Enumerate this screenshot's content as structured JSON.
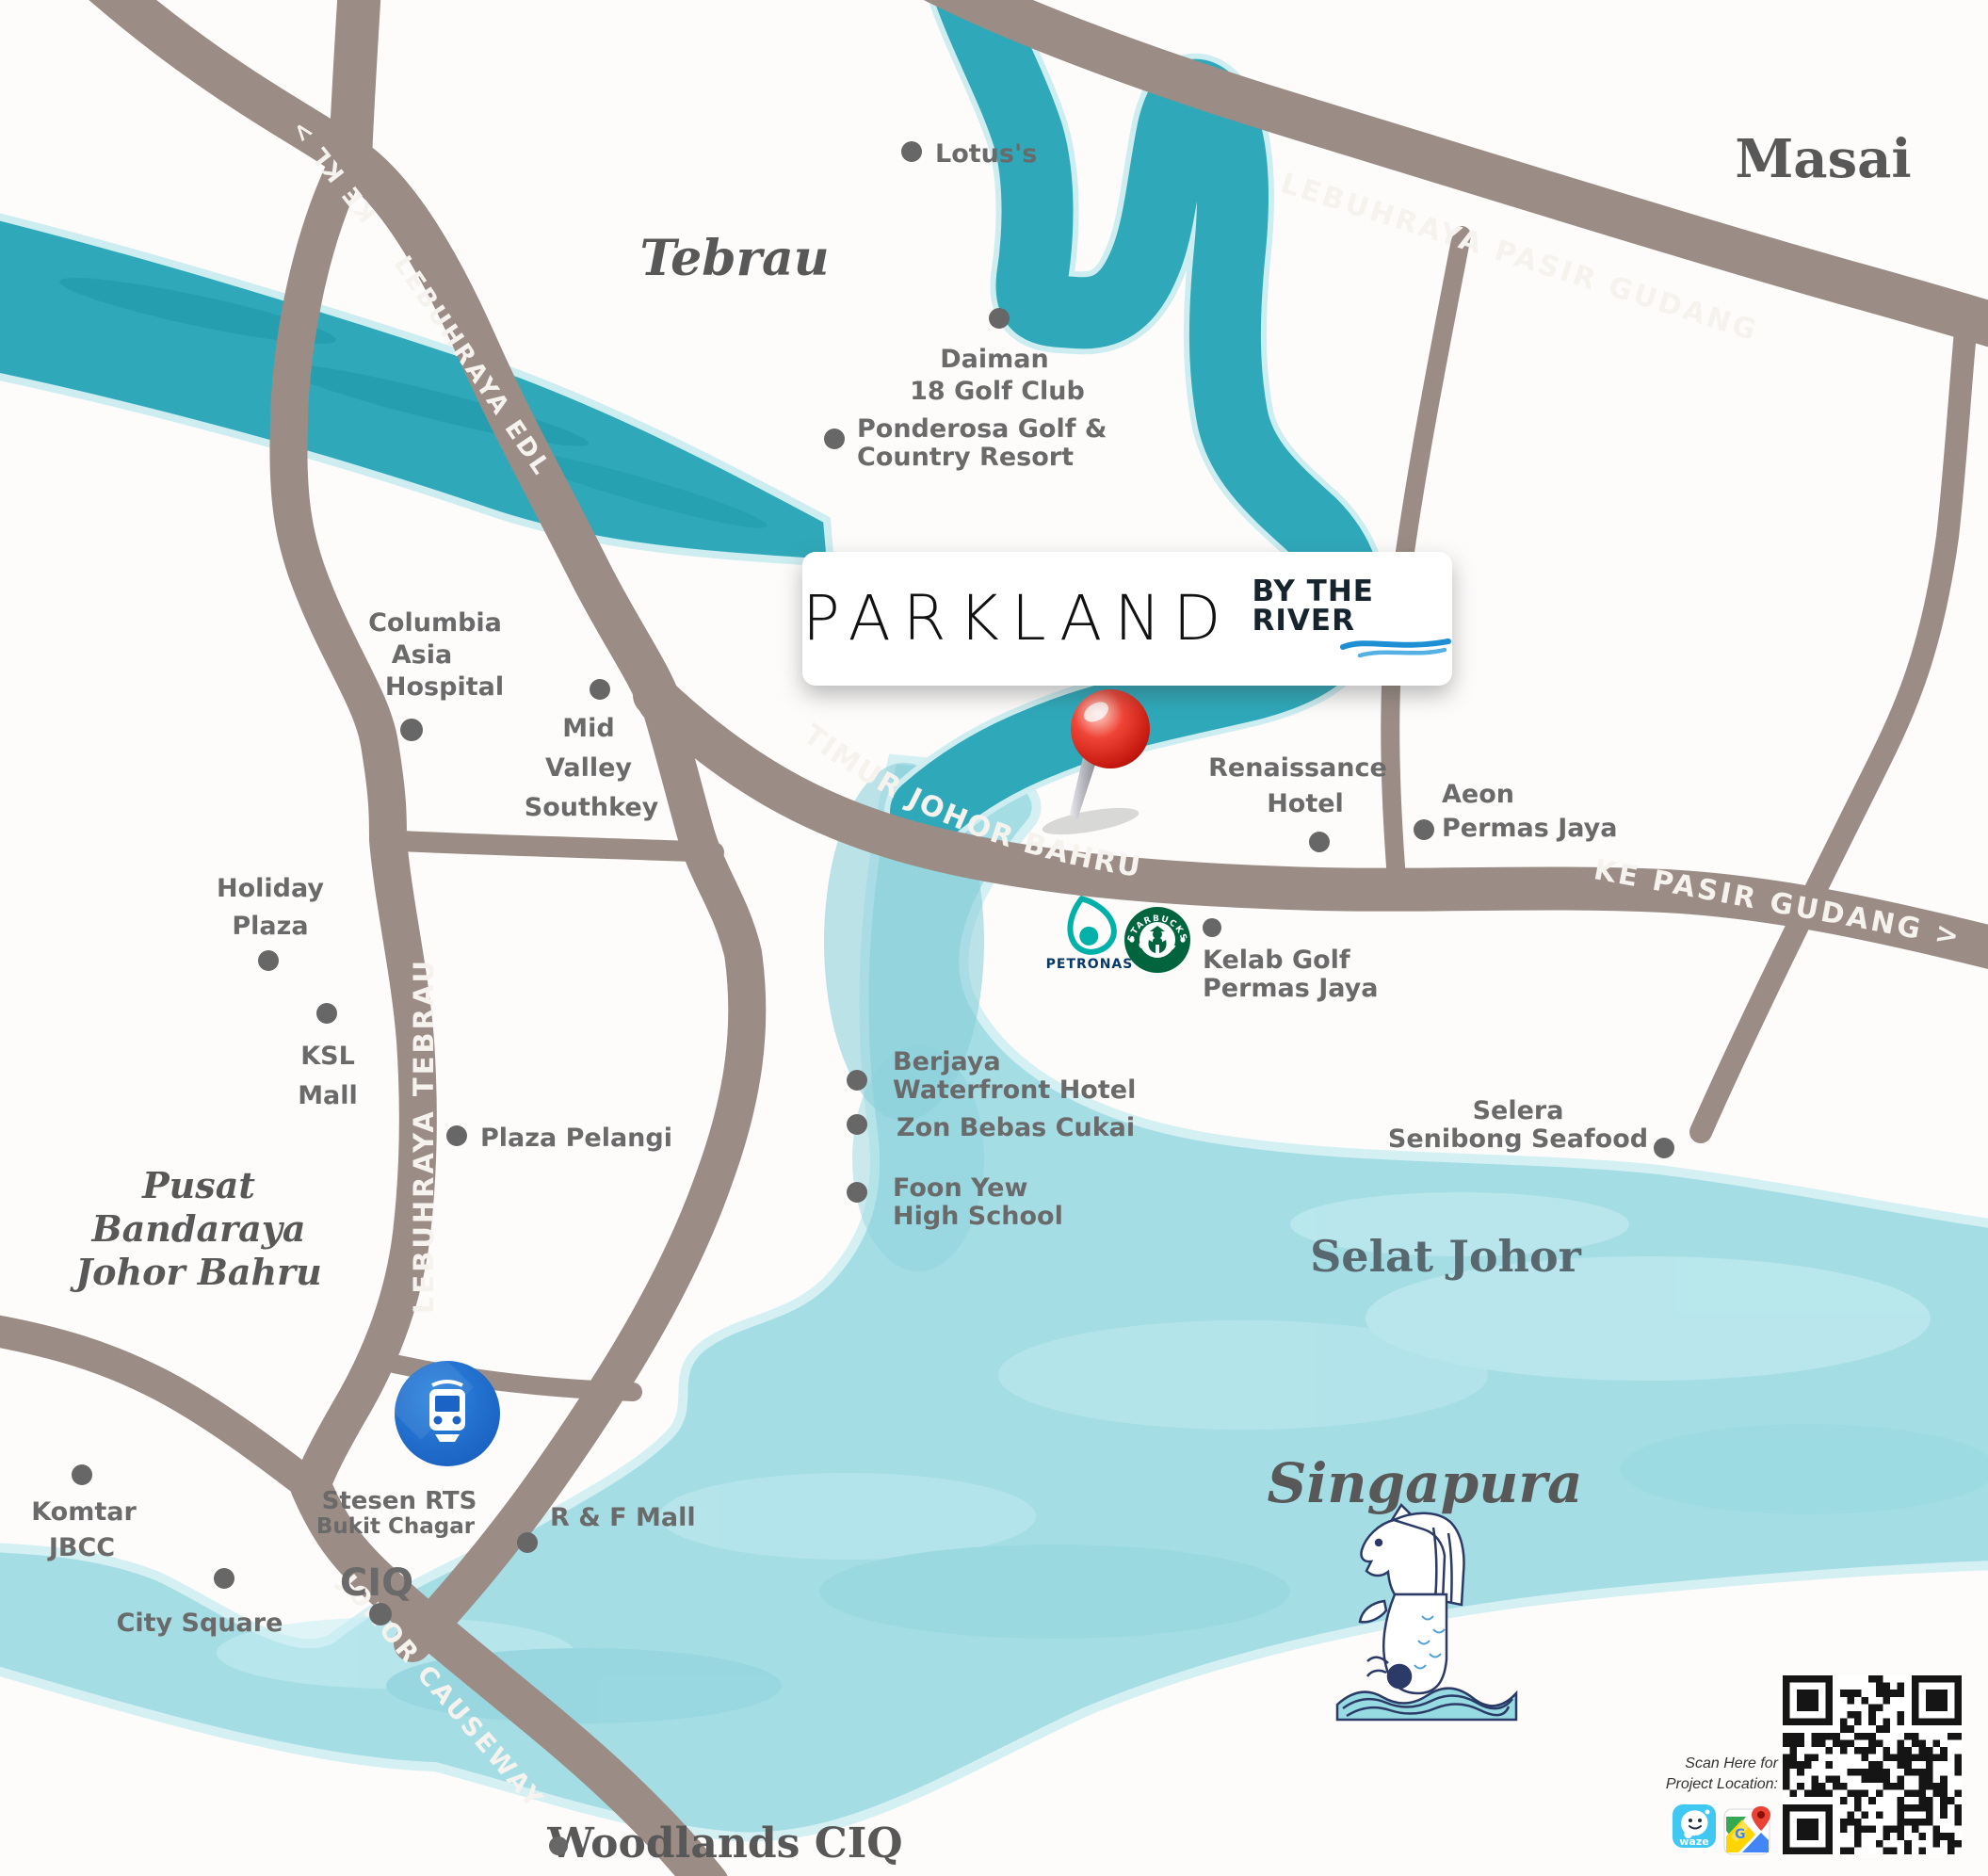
{
  "logo": {
    "title": "PARKLAND",
    "subtitle": "BY THE RIVER"
  },
  "roads": {
    "ke_kl": "KE KL >",
    "edl": "LEBUHRAYA EDL",
    "pasir_gudang": "LEBUHRAYA PASIR GUDANG",
    "pantai_timur": "LEBUHRAYA PANTAI TIMUR  JOHOR BAHRU",
    "ke_pasir_gudang": "KE PASIR GUDANG >",
    "tebrau": "LEBUHRAYA TEBRAU",
    "causeway": "JOHOR CAUSEWAY"
  },
  "regions": {
    "tebrau": "Tebrau",
    "masai": "Masai",
    "pusat_l1": "Pusat",
    "pusat_l2": "Bandaraya",
    "pusat_l3": "Johor Bahru",
    "selat_johor": "Selat Johor",
    "singapura": "Singapura",
    "woodlands": "Woodlands CIQ"
  },
  "places": {
    "lotus": "Lotus's",
    "daiman_l1": "Daiman",
    "daiman_l2": "18 Golf Club",
    "ponderosa_l1": "Ponderosa Golf &",
    "ponderosa_l2": "Country Resort",
    "columbia_l1": "Columbia",
    "columbia_l2": "Asia",
    "columbia_l3": "Hospital",
    "midvalley_l1": "Mid",
    "midvalley_l2": "Valley",
    "midvalley_l3": "Southkey",
    "holiday_l1": "Holiday",
    "holiday_l2": "Plaza",
    "ksl_l1": "KSL",
    "ksl_l2": "Mall",
    "plaza_pelangi": "Plaza Pelangi",
    "renaissance_l1": "Renaissance",
    "renaissance_l2": "Hotel",
    "aeon_l1": "Aeon",
    "aeon_l2": "Permas Jaya",
    "kelab_l1": "Kelab Golf",
    "kelab_l2": "Permas Jaya",
    "berjaya_l1": "Berjaya",
    "berjaya_l2": "Waterfront Hotel",
    "zon": "Zon Bebas Cukai",
    "foonyew_l1": "Foon Yew",
    "foonyew_l2": "High School",
    "selera_l1": "Selera",
    "selera_l2": "Senibong Seafood",
    "komtar_l1": "Komtar",
    "komtar_l2": "JBCC",
    "city_square": "City Square",
    "stesen_l1": "Stesen RTS",
    "stesen_l2": "Bukit Chagar",
    "ciq": "CIQ",
    "rf_mall": "R & F Mall"
  },
  "brands": {
    "petronas": "PETRONAS",
    "starbucks_top": "STARBUCKS",
    "starbucks_bottom": "COFFEE",
    "waze": "waze",
    "gmaps_letter": "G"
  },
  "qr": {
    "caption_l1": "Scan Here for",
    "caption_l2": "Project Location:"
  },
  "colors": {
    "road": "#9b8d85",
    "river_dark": "#2fa9ba",
    "sea_light": "#a5dde5",
    "accent_red": "#d22a1d",
    "petronas_teal": "#00b1a9",
    "starbucks_green": "#00653e",
    "waze_blue": "#3ec8f2",
    "train_blue": "#1a66c9"
  }
}
